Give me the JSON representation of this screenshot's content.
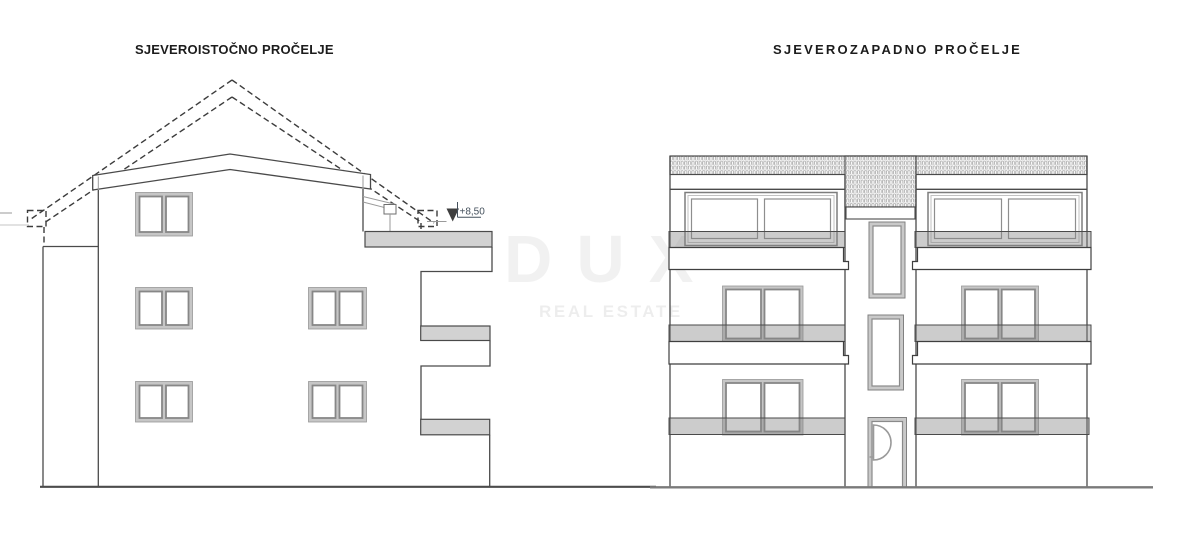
{
  "colors": {
    "background": "#ffffff",
    "title_text": "#1c1c1c",
    "line_dark": "#4a4a4a",
    "line_light": "#9a9a9a",
    "slab_fill": "#d2d2d2",
    "frame_light": "#c6c6c6",
    "frame_dark": "#878787",
    "railing_fill": "rgba(134,134,134,0.42)",
    "ground_line": "#7a7a7a",
    "watermark_gray": "rgba(0,0,0,0.055)",
    "watermark_tag": "rgba(0,0,0,0.07)",
    "elevation_text": "#44505c"
  },
  "left_drawing": {
    "title": "SJEVEROISTOČNO PROČELJE",
    "elevation_marker_label": "+8,50"
  },
  "right_drawing": {
    "title": "SJEVEROZAPADNO PROČELJE"
  },
  "watermark": {
    "brand": "DUX",
    "tagline": "REAL ESTATE"
  }
}
